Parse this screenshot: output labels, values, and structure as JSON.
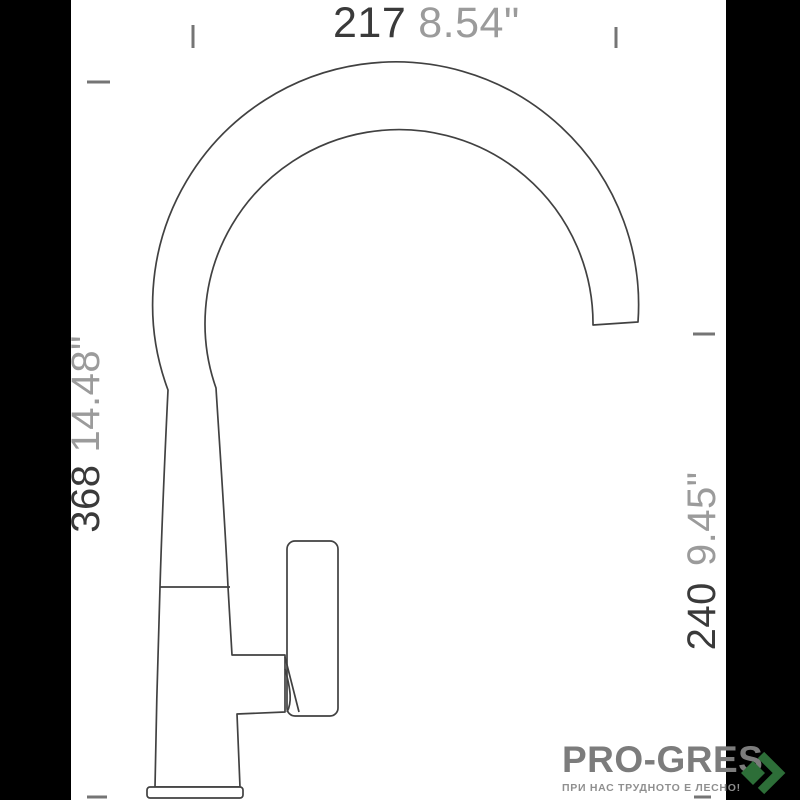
{
  "page": {
    "background": "#ffffff",
    "pillarbox_color": "#000000"
  },
  "drawing": {
    "subject": "single-lever kitchen faucet, side elevation with dimensions",
    "line_color": "#414141",
    "tick_color": "#757575",
    "dimensions": [
      {
        "id": "overall-width-top",
        "mm": "217",
        "inches": "8.54\"",
        "orientation": "horizontal"
      },
      {
        "id": "overall-height-left",
        "mm": "368",
        "inches": "14.48\"",
        "orientation": "vertical"
      },
      {
        "id": "spout-height-right",
        "mm": "240",
        "inches": "9.45\"",
        "orientation": "vertical"
      }
    ]
  },
  "branding": {
    "logo": "PRO-GRES",
    "tagline": "ПРИ НАС ТРУДНОТО Е ЛЕСНО!",
    "logo_color": "#7c7c7c",
    "green": "#2d6e38"
  }
}
